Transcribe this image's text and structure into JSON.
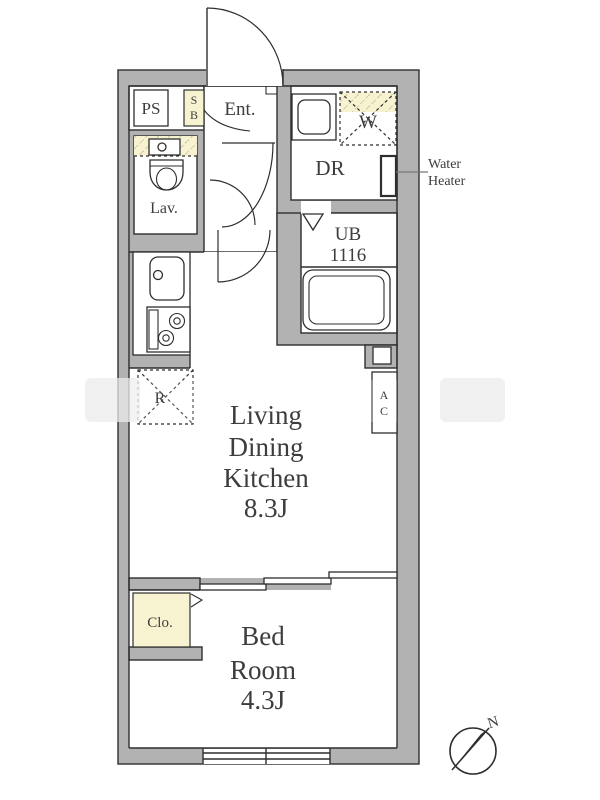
{
  "rooms": {
    "ldk": {
      "line1": "Living",
      "line2": "Dining",
      "line3": "Kitchen",
      "size": "8.3J"
    },
    "bedroom": {
      "line1": "Bed",
      "line2": "Room",
      "size": "4.3J"
    },
    "entrance": {
      "label": "Ent."
    },
    "lavatory": {
      "label": "Lav."
    },
    "dressing_room": {
      "label": "DR"
    },
    "unit_bath": {
      "label": "UB",
      "size": "1116"
    },
    "closet": {
      "label": "Clo."
    }
  },
  "fixtures": {
    "pipe_shaft": {
      "label": "PS"
    },
    "shoe_box": {
      "line1": "S",
      "line2": "B"
    },
    "washer": {
      "label": "W"
    },
    "refrigerator": {
      "label": "R"
    },
    "air_conditioner": {
      "line1": "A",
      "line2": "C"
    },
    "water_heater": {
      "line1": "Water",
      "line2": "Heater"
    }
  },
  "compass": {
    "north": "N"
  },
  "colors": {
    "wall": "#b2b2b2",
    "line": "#2e2e2e",
    "text": "#3d3d3d",
    "accent_yellow": "#f7f3d0",
    "paper": "#ffffff"
  }
}
